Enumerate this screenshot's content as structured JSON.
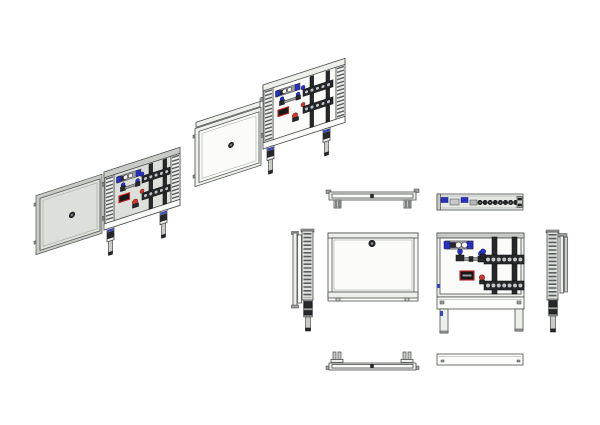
{
  "page": {
    "background": "#ffffff",
    "sheet_width_px": 600,
    "sheet_height_px": 425
  },
  "colors": {
    "page_bg": "#ffffff",
    "line": "#4a4d4b",
    "line_dark": "#111214",
    "panel_white": "#fbfcfa",
    "panel_light": "#edefeb",
    "panel_gray": "#dcdfda",
    "panel_shade": "#c8cbc6",
    "metal_dark": "#26282a",
    "metal_mid": "#9ca09d",
    "rung": "#5a5e60",
    "valve_blue": "#2732c0",
    "valve_blue_light": "#8a92e4",
    "valve_red": "#ce3a30",
    "label_red": "#c32020",
    "label_dark": "#17181a",
    "leg_blue": "#3246be",
    "port_light": "#c2c6ca",
    "pipe_gray": "#9ea2a2"
  },
  "structure": {
    "manifold_bars": 2,
    "ports_per_bar_front_view": 7,
    "ports_per_bar_iso_view": 5,
    "top_view_port_count": 8,
    "flow_meter_sight_glasses": 2,
    "cabinet_legs": 2
  },
  "views": {
    "iso_exploded_a": "Isometric exploded view A - door removed from manifold cabinet",
    "iso_exploded_b": "Isometric exploded view B - door removed from manifold cabinet",
    "top_closed": "Top view - cabinet closed",
    "top_open": "Top view - open cabinet showing manifold",
    "front_closed": "Front view - door closed with lock",
    "front_open": "Front view - open cabinet with manifold assembly",
    "side_left": "Left side view with mounting rail and leg",
    "side_right": "Right side view with mounting rail and leg",
    "bottom_closed": "Bottom view - closed cabinet",
    "bottom_open": "Bottom view - open cabinet"
  }
}
